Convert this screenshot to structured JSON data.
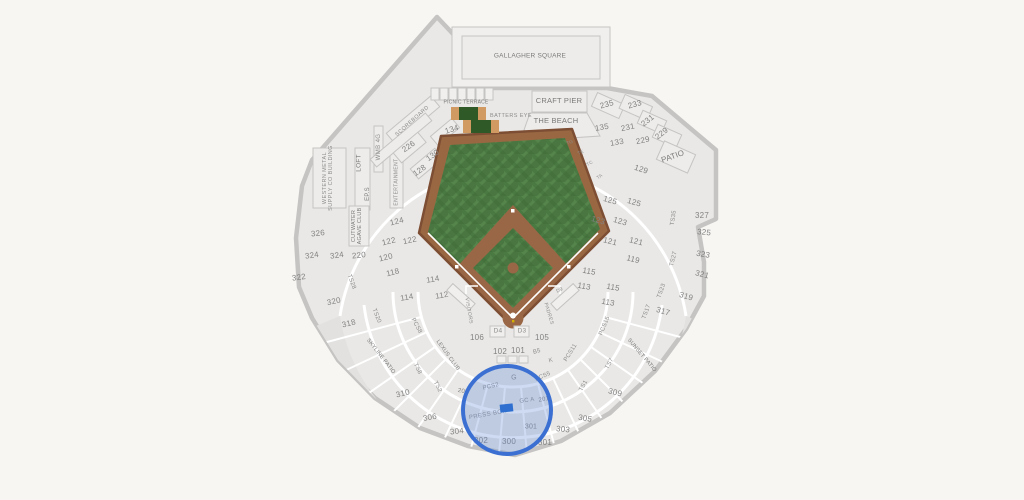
{
  "map_title": "Ballpark seating map",
  "colors": {
    "bg": "#f7f6f3",
    "bowl": "#e9e8e6",
    "upper_deck": "#e2e1df",
    "wall": "#c5c4c2",
    "grass": "#4a7741",
    "grass_dark": "#3f6a38",
    "grass_light": "#55854b",
    "dirt": "#9a6746",
    "warning_track": "#996842",
    "batters_eye_green": "#2f5a28",
    "batters_eye_tan": "#d09a62",
    "selection_stroke": "#3b70d2",
    "selection_fill": "rgba(102,143,214,0.32)",
    "selected_marker": "#2e6fd0",
    "label": "#828282"
  },
  "selection": {
    "circle": {
      "cx": 507,
      "cy": 410,
      "r": 44
    },
    "marker": {
      "x": 500,
      "y": 404,
      "w": 13,
      "h": 8,
      "rot": -6
    }
  },
  "labels": [
    {
      "t": "GALLAGHER SQUARE",
      "x": 530,
      "y": 57,
      "fs": 6.5,
      "k": "area"
    },
    {
      "t": "PICNIC TERRACE",
      "x": 466,
      "y": 103,
      "fs": 5,
      "k": "area"
    },
    {
      "t": "CRAFT PIER",
      "x": 559,
      "y": 101,
      "fs": 7.5,
      "k": "area"
    },
    {
      "t": "BATTERS EYE",
      "x": 511,
      "y": 117,
      "fs": 5.5,
      "k": "struct"
    },
    {
      "t": "THE BEACH",
      "x": 556,
      "y": 121,
      "fs": 7.5,
      "k": "area"
    },
    {
      "t": "SCOREBOARD",
      "x": 413,
      "y": 122,
      "fs": 5.5,
      "r": -42,
      "k": "struct"
    },
    {
      "t": "WMB 4G",
      "x": 379,
      "y": 147,
      "fs": 6,
      "r": -90,
      "k": "struct"
    },
    {
      "t": "LOFT",
      "x": 360,
      "y": 163,
      "fs": 6.5,
      "r": -90,
      "k": "area"
    },
    {
      "t": "EP.S",
      "x": 368,
      "y": 194,
      "fs": 6,
      "r": -90,
      "k": "area"
    },
    {
      "t": "ENTERTAINMENT",
      "x": 397,
      "y": 182,
      "fs": 5,
      "r": -90,
      "k": "struct"
    },
    {
      "t": "WESTERN METAL\nSUPPLY CO BUILDING",
      "x": 329,
      "y": 178,
      "fs": 5.5,
      "r": -90,
      "k": "struct"
    },
    {
      "t": "CUTWATER\nAGAVE CLUB",
      "x": 358,
      "y": 226,
      "fs": 5.5,
      "r": -90,
      "k": "area"
    },
    {
      "t": "PATIO",
      "x": 673,
      "y": 157,
      "fs": 8,
      "r": -20,
      "k": "area"
    },
    {
      "t": "SKYLINE PATIO",
      "x": 380,
      "y": 357,
      "fs": 5.5,
      "r": 52,
      "k": "area"
    },
    {
      "t": "SUNSET PATIO",
      "x": 641,
      "y": 356,
      "fs": 5.5,
      "r": 50,
      "k": "area"
    },
    {
      "t": "LEXUS CLUB",
      "x": 447,
      "y": 356,
      "fs": 5.5,
      "r": 54,
      "k": "area"
    },
    {
      "t": "PRESS BOX",
      "x": 488,
      "y": 415,
      "fs": 6,
      "r": -10,
      "k": "struct"
    },
    {
      "t": "VISITORS",
      "x": 468,
      "y": 311,
      "fs": 5,
      "r": 80,
      "k": "struct"
    },
    {
      "t": "PADRES",
      "x": 548,
      "y": 314,
      "fs": 5,
      "r": 73,
      "k": "struct"
    },
    {
      "t": "GC A",
      "x": 527,
      "y": 401,
      "fs": 6,
      "r": -8,
      "k": "suite"
    },
    {
      "t": "G",
      "x": 514,
      "y": 378,
      "fs": 7,
      "k": "suite"
    },
    {
      "t": "D4",
      "x": 498,
      "y": 332,
      "fs": 6.5,
      "k": "suite"
    },
    {
      "t": "D3",
      "x": 522,
      "y": 332,
      "fs": 6.5,
      "k": "suite"
    },
    {
      "t": "D9",
      "x": 560,
      "y": 291,
      "fs": 5,
      "r": -25,
      "k": "suite"
    },
    {
      "t": "B5",
      "x": 537,
      "y": 352,
      "fs": 6,
      "r": -15,
      "k": "suite"
    },
    {
      "t": "K",
      "x": 551,
      "y": 361,
      "fs": 6,
      "r": -15,
      "k": "suite"
    },
    {
      "t": "TG",
      "x": 570,
      "y": 143,
      "fs": 4.5,
      "r": -20,
      "k": "suite"
    },
    {
      "t": "TE",
      "x": 581,
      "y": 153,
      "fs": 4.5,
      "r": -25,
      "k": "suite"
    },
    {
      "t": "TC",
      "x": 590,
      "y": 164,
      "fs": 4.5,
      "r": -30,
      "k": "suite"
    },
    {
      "t": "TA",
      "x": 600,
      "y": 177,
      "fs": 4.5,
      "r": -35,
      "k": "suite"
    },
    {
      "t": "PCS2",
      "x": 491,
      "y": 387,
      "fs": 6,
      "r": -14,
      "k": "suite"
    },
    {
      "t": "PCS5",
      "x": 543,
      "y": 377,
      "fs": 6,
      "r": -24,
      "k": "suite"
    },
    {
      "t": "PCS8",
      "x": 416,
      "y": 326,
      "fs": 6,
      "r": 62,
      "k": "suite"
    },
    {
      "t": "PCS11",
      "x": 571,
      "y": 353,
      "fs": 6,
      "r": -58,
      "k": "suite"
    },
    {
      "t": "PCS15",
      "x": 605,
      "y": 326,
      "fs": 6,
      "r": -68,
      "k": "suite"
    },
    {
      "t": "TS1",
      "x": 584,
      "y": 386,
      "fs": 6,
      "r": -62,
      "k": "suite"
    },
    {
      "t": "TS2",
      "x": 437,
      "y": 387,
      "fs": 6,
      "r": 62,
      "k": "suite"
    },
    {
      "t": "TS7",
      "x": 610,
      "y": 364,
      "fs": 6,
      "r": -62,
      "k": "suite"
    },
    {
      "t": "TS8",
      "x": 417,
      "y": 369,
      "fs": 6,
      "r": 64,
      "k": "suite"
    },
    {
      "t": "TS17",
      "x": 647,
      "y": 312,
      "fs": 6,
      "r": -70,
      "k": "suite"
    },
    {
      "t": "TS20",
      "x": 376,
      "y": 316,
      "fs": 6,
      "r": 68,
      "k": "suite"
    },
    {
      "t": "TS23",
      "x": 662,
      "y": 291,
      "fs": 6,
      "r": -70,
      "k": "suite"
    },
    {
      "t": "TS27",
      "x": 674,
      "y": 259,
      "fs": 6,
      "r": -76,
      "k": "suite"
    },
    {
      "t": "TS28",
      "x": 351,
      "y": 282,
      "fs": 6,
      "r": 70,
      "k": "suite"
    },
    {
      "t": "TS35",
      "x": 674,
      "y": 218,
      "fs": 6,
      "r": -82,
      "k": "suite"
    },
    {
      "t": "201",
      "x": 544,
      "y": 400,
      "fs": 6,
      "r": -10,
      "k": "section"
    },
    {
      "t": "202",
      "x": 463,
      "y": 392,
      "fs": 6,
      "r": 10,
      "k": "section"
    },
    {
      "t": "101",
      "x": 518,
      "y": 351,
      "fs": 8,
      "k": "section"
    },
    {
      "t": "102",
      "x": 500,
      "y": 352,
      "fs": 8,
      "k": "section"
    },
    {
      "t": "105",
      "x": 542,
      "y": 338,
      "fs": 8,
      "k": "section"
    },
    {
      "t": "106",
      "x": 477,
      "y": 338,
      "fs": 8,
      "k": "section"
    },
    {
      "t": "112",
      "x": 442,
      "y": 296,
      "fs": 8,
      "r": -10,
      "k": "section"
    },
    {
      "t": "113",
      "x": 584,
      "y": 287,
      "fs": 8,
      "r": 10,
      "k": "section"
    },
    {
      "t": "113",
      "x": 608,
      "y": 303,
      "fs": 8,
      "r": 10,
      "k": "section"
    },
    {
      "t": "114",
      "x": 433,
      "y": 280,
      "fs": 8,
      "r": -10,
      "k": "section"
    },
    {
      "t": "114",
      "x": 407,
      "y": 298,
      "fs": 8,
      "r": -10,
      "k": "section"
    },
    {
      "t": "115",
      "x": 589,
      "y": 272,
      "fs": 8,
      "r": 10,
      "k": "section"
    },
    {
      "t": "115",
      "x": 613,
      "y": 288,
      "fs": 8,
      "r": 10,
      "k": "section"
    },
    {
      "t": "118",
      "x": 393,
      "y": 273,
      "fs": 8,
      "r": -14,
      "k": "section"
    },
    {
      "t": "119",
      "x": 633,
      "y": 260,
      "fs": 8,
      "r": 14,
      "k": "section"
    },
    {
      "t": "120",
      "x": 386,
      "y": 258,
      "fs": 8,
      "r": -14,
      "k": "section"
    },
    {
      "t": "121",
      "x": 610,
      "y": 242,
      "fs": 8,
      "r": 14,
      "k": "section"
    },
    {
      "t": "121",
      "x": 636,
      "y": 242,
      "fs": 8,
      "r": 14,
      "k": "section"
    },
    {
      "t": "122",
      "x": 389,
      "y": 242,
      "fs": 8,
      "r": -14,
      "k": "section"
    },
    {
      "t": "122",
      "x": 410,
      "y": 241,
      "fs": 8,
      "r": -12,
      "k": "section"
    },
    {
      "t": "123",
      "x": 598,
      "y": 221,
      "fs": 8,
      "r": 16,
      "k": "section"
    },
    {
      "t": "123",
      "x": 620,
      "y": 222,
      "fs": 8,
      "r": 16,
      "k": "section"
    },
    {
      "t": "124",
      "x": 397,
      "y": 222,
      "fs": 8,
      "r": -14,
      "k": "section"
    },
    {
      "t": "125",
      "x": 610,
      "y": 201,
      "fs": 8,
      "r": 16,
      "k": "section"
    },
    {
      "t": "125",
      "x": 634,
      "y": 203,
      "fs": 8,
      "r": 16,
      "k": "section"
    },
    {
      "t": "128",
      "x": 420,
      "y": 171,
      "fs": 8,
      "r": -35,
      "k": "section"
    },
    {
      "t": "129",
      "x": 641,
      "y": 170,
      "fs": 8,
      "r": 18,
      "k": "section"
    },
    {
      "t": "130",
      "x": 433,
      "y": 156,
      "fs": 8,
      "r": -35,
      "k": "section"
    },
    {
      "t": "133",
      "x": 617,
      "y": 143,
      "fs": 8,
      "r": -10,
      "k": "section"
    },
    {
      "t": "134",
      "x": 452,
      "y": 130,
      "fs": 8,
      "r": -18,
      "k": "section"
    },
    {
      "t": "135",
      "x": 602,
      "y": 128,
      "fs": 8,
      "r": -10,
      "k": "section"
    },
    {
      "t": "226",
      "x": 409,
      "y": 147,
      "fs": 8,
      "r": -35,
      "k": "section"
    },
    {
      "t": "229",
      "x": 662,
      "y": 134,
      "fs": 8,
      "r": -38,
      "k": "section"
    },
    {
      "t": "229",
      "x": 643,
      "y": 141,
      "fs": 8,
      "r": -12,
      "k": "section"
    },
    {
      "t": "231",
      "x": 648,
      "y": 121,
      "fs": 8,
      "r": -38,
      "k": "section"
    },
    {
      "t": "231",
      "x": 628,
      "y": 128,
      "fs": 8,
      "r": -12,
      "k": "section"
    },
    {
      "t": "233",
      "x": 635,
      "y": 105,
      "fs": 8,
      "r": -16,
      "k": "section"
    },
    {
      "t": "235",
      "x": 607,
      "y": 105,
      "fs": 8,
      "r": -16,
      "k": "section"
    },
    {
      "t": "220",
      "x": 359,
      "y": 256,
      "fs": 8,
      "r": -6,
      "k": "section"
    },
    {
      "t": "300",
      "x": 509,
      "y": 442,
      "fs": 8,
      "k": "section"
    },
    {
      "t": "301",
      "x": 531,
      "y": 427,
      "fs": 7,
      "k": "section"
    },
    {
      "t": "301",
      "x": 545,
      "y": 443,
      "fs": 8,
      "k": "section"
    },
    {
      "t": "302",
      "x": 481,
      "y": 441,
      "fs": 8,
      "k": "section"
    },
    {
      "t": "303",
      "x": 563,
      "y": 430,
      "fs": 8,
      "r": 6,
      "k": "section"
    },
    {
      "t": "304",
      "x": 457,
      "y": 432,
      "fs": 8,
      "r": -6,
      "k": "section"
    },
    {
      "t": "305",
      "x": 585,
      "y": 419,
      "fs": 8,
      "r": 10,
      "k": "section"
    },
    {
      "t": "306",
      "x": 430,
      "y": 418,
      "fs": 8,
      "r": -10,
      "k": "section"
    },
    {
      "t": "309",
      "x": 615,
      "y": 393,
      "fs": 8,
      "r": 14,
      "k": "section"
    },
    {
      "t": "310",
      "x": 403,
      "y": 394,
      "fs": 8,
      "r": -14,
      "k": "section"
    },
    {
      "t": "317",
      "x": 663,
      "y": 312,
      "fs": 8,
      "r": 16,
      "k": "section"
    },
    {
      "t": "318",
      "x": 349,
      "y": 324,
      "fs": 8,
      "r": -14,
      "k": "section"
    },
    {
      "t": "319",
      "x": 686,
      "y": 297,
      "fs": 8,
      "r": 16,
      "k": "section"
    },
    {
      "t": "320",
      "x": 334,
      "y": 302,
      "fs": 8,
      "r": -12,
      "k": "section"
    },
    {
      "t": "321",
      "x": 702,
      "y": 275,
      "fs": 8,
      "r": 14,
      "k": "section"
    },
    {
      "t": "322",
      "x": 299,
      "y": 278,
      "fs": 8,
      "r": -8,
      "k": "section"
    },
    {
      "t": "323",
      "x": 703,
      "y": 255,
      "fs": 8,
      "r": 10,
      "k": "section"
    },
    {
      "t": "324",
      "x": 312,
      "y": 256,
      "fs": 8,
      "r": -8,
      "k": "section"
    },
    {
      "t": "324",
      "x": 337,
      "y": 256,
      "fs": 8,
      "r": -8,
      "k": "section"
    },
    {
      "t": "325",
      "x": 704,
      "y": 233,
      "fs": 8,
      "r": 6,
      "k": "section"
    },
    {
      "t": "326",
      "x": 318,
      "y": 234,
      "fs": 8,
      "r": -6,
      "k": "section"
    },
    {
      "t": "327",
      "x": 702,
      "y": 216,
      "fs": 8,
      "k": "section"
    }
  ]
}
